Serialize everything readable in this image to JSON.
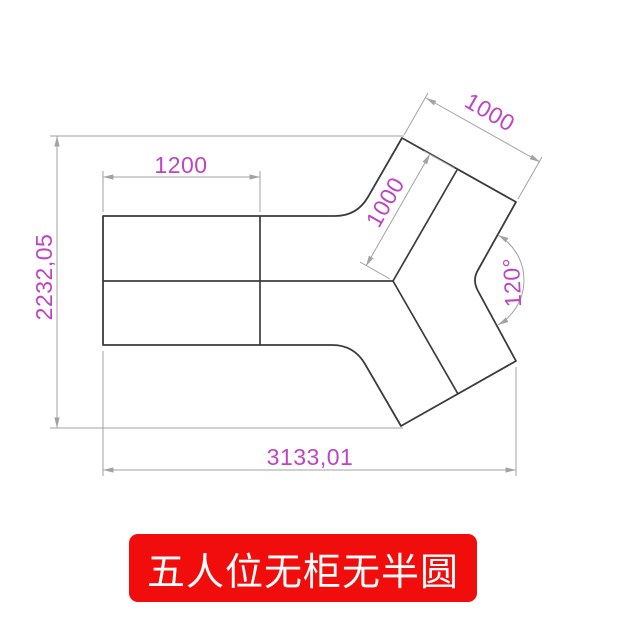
{
  "banner": {
    "label": "五人位无柜无半圆",
    "bg_color": "#f20d0d",
    "text_color": "#ffffff"
  },
  "drawing": {
    "type": "cad-dimension-diagram",
    "subject": "five-seat Y-shaped desk top view",
    "outline_color": "#3b3b3b",
    "dimension_line_color": "#a2a2a2",
    "dimension_text_color": "#bf44c3",
    "dimension_labels": {
      "left_desk_width": "1200",
      "overall_height": "2232,05",
      "overall_width": "3133,01",
      "arm_end_width": "1000",
      "arm_divider_length": "1000",
      "arm_angle": "120°"
    }
  }
}
